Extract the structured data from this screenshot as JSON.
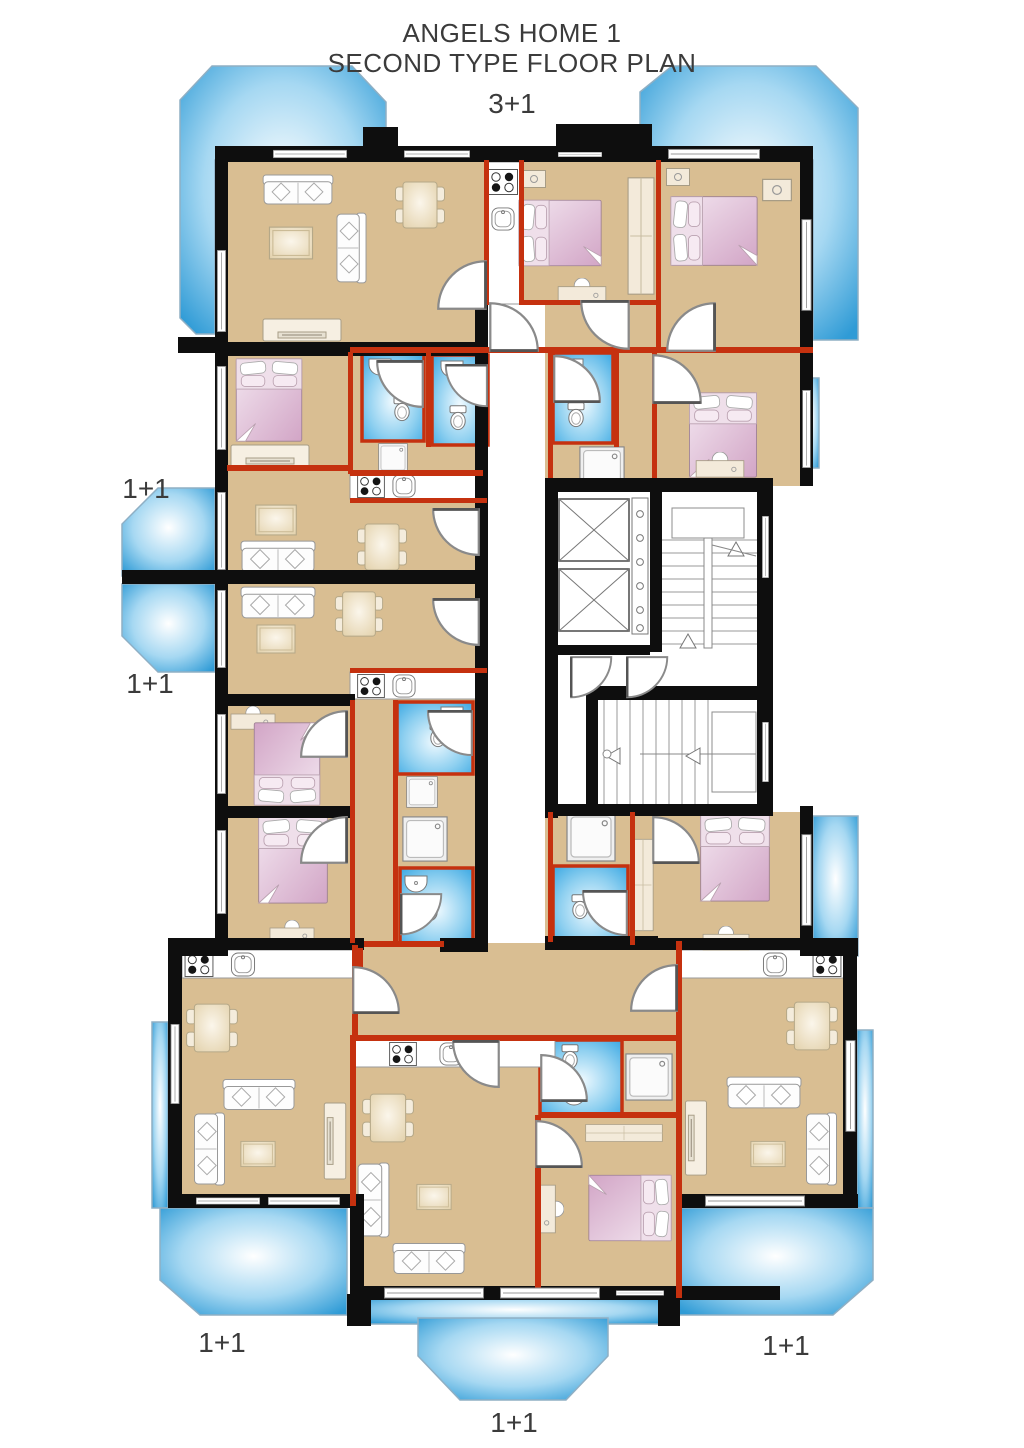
{
  "title": {
    "line1": "ANGELS HOME 1",
    "line2": "SECOND TYPE FLOOR PLAN"
  },
  "units": {
    "top": "3+1",
    "left_upper": "1+1",
    "left_lower": "1+1",
    "bottom_left": "1+1",
    "bottom_center": "1+1",
    "bottom_right": "1+1"
  },
  "colors": {
    "floor_tan": "#D9BE92",
    "wall_black": "#0E0E0E",
    "partition_red": "#C5310F",
    "balcony_blue": "#2F9BD6",
    "balcony_mid": "#A6D8F2",
    "bathroom_blue": "#36A6E2",
    "bathroom_mid": "#8FD0F0",
    "bed_pink_light": "#F3E6F0",
    "bed_pink_deep": "#D2A5C6",
    "furniture_cream": "#F2E9D8",
    "table_cream": "#E4D3AE",
    "fixture_white": "#FFFFFF",
    "outline_gray": "#8C8C8C",
    "text_dark": "#3B3B3B"
  }
}
